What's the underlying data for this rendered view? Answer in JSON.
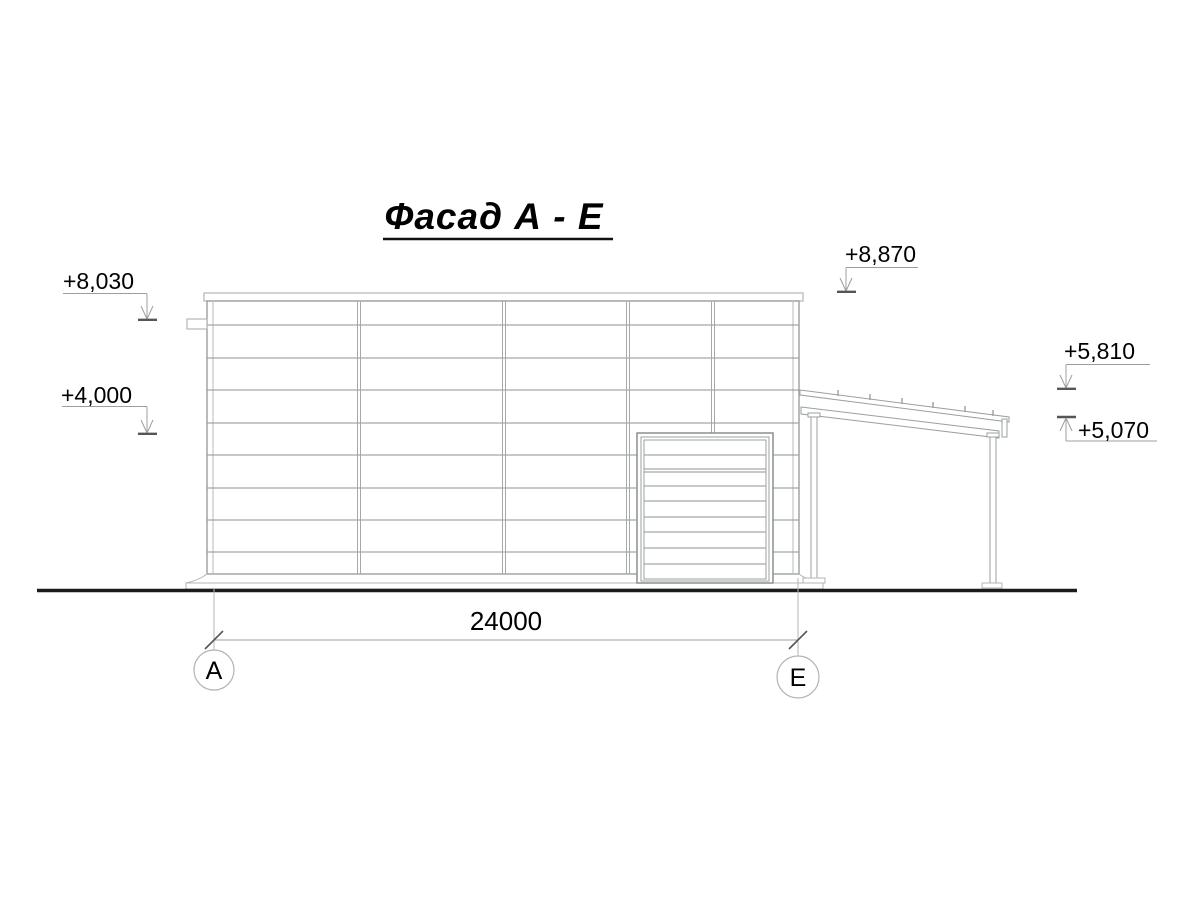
{
  "title": {
    "text": "Фасад А - Е"
  },
  "elevations": {
    "m8030": "+8,030",
    "m4000": "+4,000",
    "m8870": "+8,870",
    "m5810": "+5,810",
    "m5070": "+5,070"
  },
  "dimension": {
    "span": "24000"
  },
  "axes": {
    "left": "А",
    "right": "Е"
  },
  "colors": {
    "line_light": "#b6babc",
    "line_mid": "#96999b",
    "line_dark": "#555555",
    "ground": "#1b1b1b",
    "text": "#000000",
    "background": "#ffffff"
  }
}
